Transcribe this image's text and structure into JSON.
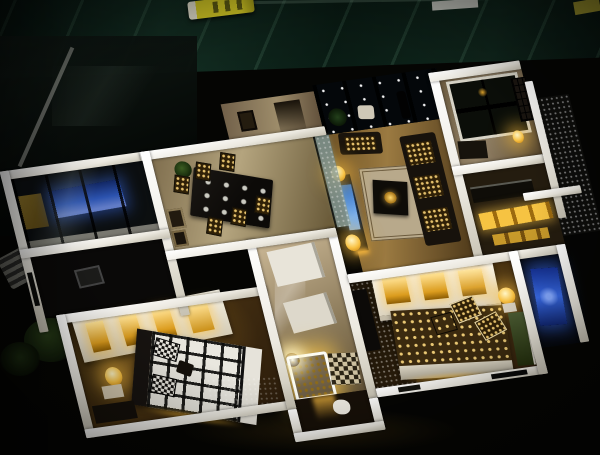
{
  "scene": {
    "type": "photograph",
    "subject": "Illuminated architectural scale model of an apartment floor plan on a dark marble table, viewed from above at night",
    "alt": "Top-down night photo of a lit miniature apartment model: white walls outline a dining room with a dark table and patterned chairs, a living room with sofas, TV and glowing amber lamps, a dark starry balcony behind glass doors, a master bedroom with a black-and-white plaid bed and glowing bay wardrobe, a second bedroom with a polka-dot bed and lit white wardrobe, a gold-lit shower room with checkered tile floor, a blue-LED kitchen nook at the upper left, a blue-lit bathroom at the right edge, and miniature patio furniture outside; a yellow marker rests on the marble above the model."
  },
  "rooms": [
    {
      "name": "balcony-kitchen-nook",
      "lighting": "blue-led"
    },
    {
      "name": "dining-room",
      "lighting": "warm"
    },
    {
      "name": "living-room",
      "lighting": "warm-amber-lamps"
    },
    {
      "name": "balcony",
      "lighting": "dark-starry-ceiling"
    },
    {
      "name": "study-room",
      "lighting": "dim-amber"
    },
    {
      "name": "kitchen",
      "lighting": "lit-cabinets"
    },
    {
      "name": "hallway",
      "lighting": "neutral"
    },
    {
      "name": "master-bedroom",
      "lighting": "warm-glow"
    },
    {
      "name": "second-bedroom",
      "lighting": "warm-glow"
    },
    {
      "name": "shower-room",
      "lighting": "bright-gold"
    },
    {
      "name": "bathroom-right",
      "lighting": "blue-led"
    },
    {
      "name": "patio",
      "lighting": "unlit"
    }
  ],
  "objects": [
    "yellow-marker",
    "white-paper-slip",
    "dining-table",
    "dining-chairs",
    "sofa",
    "tv-screen",
    "table-lamps",
    "plaid-bed",
    "checkered-pillows",
    "polka-dot-bed",
    "lit-wardrobes",
    "round-bedside-lamp",
    "toilet",
    "lounge-chair",
    "round-patio-table",
    "shrub"
  ],
  "palette": {
    "bg": "#050503",
    "marble": "#0e231a",
    "marble-vein": "#3c6450",
    "wall": "#ece9e0",
    "wall-shade": "#c6c1b3",
    "glow-warm": "#f6c24a",
    "glow-deep": "#c07d10",
    "floor-tan": "#b3a480",
    "floor-wood": "#8a6a34",
    "floor-dark": "#241a0c",
    "blue-led": "#2a5ae0",
    "blue-light": "#7fa0ff",
    "tv-blue": "#3a7bd0",
    "bed-white": "#e9e7df",
    "plant-green": "#2e4a1e",
    "marker-yellow": "#e8dc28"
  }
}
